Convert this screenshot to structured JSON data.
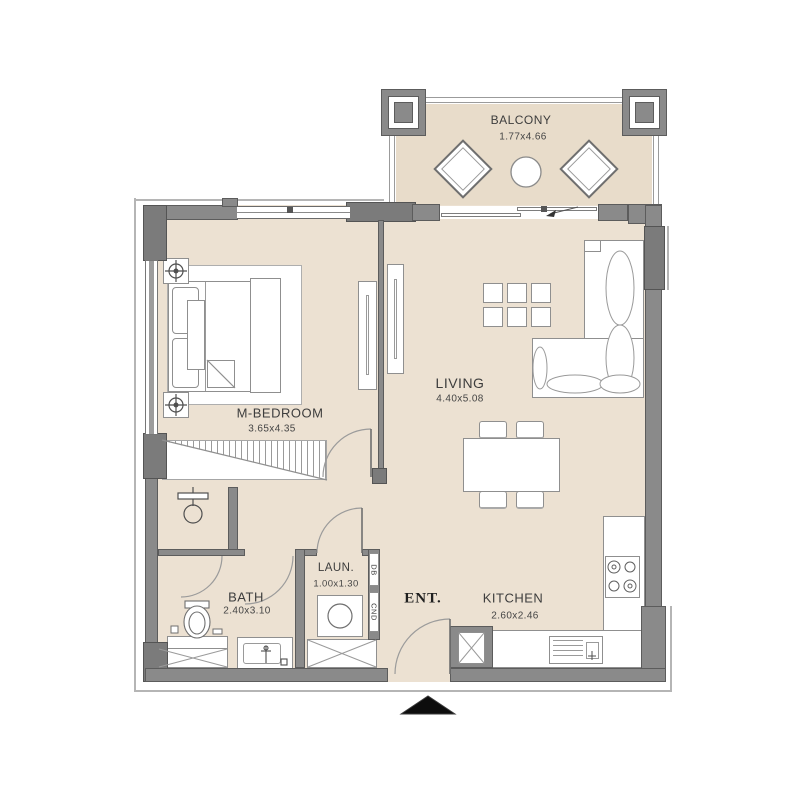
{
  "plan_type": "apartment-floor-plan",
  "rooms": {
    "balcony": {
      "label": "BALCONY",
      "dims": "1.77x4.66"
    },
    "living": {
      "label": "LIVING",
      "dims": "4.40x5.08"
    },
    "bedroom": {
      "label": "M-BEDROOM",
      "dims": "3.65x4.35"
    },
    "bath": {
      "label": "BATH",
      "dims": "2.40x3.10"
    },
    "laundry": {
      "label": "LAUN.",
      "dims": "1.00x1.30"
    },
    "entry": {
      "label": "ENT."
    },
    "kitchen": {
      "label": "KITCHEN",
      "dims": "2.60x2.46"
    }
  },
  "panels": {
    "db": "DB",
    "cnd": "CND"
  },
  "colors": {
    "floor": "#ece1d2",
    "balcony_floor": "#e8dcca",
    "wall": "#8a8a8a",
    "wall_outline": "#5c5c5c",
    "furniture_line": "#8f8f8f",
    "text": "#3d3d3d",
    "entrance_marker": "#0d0d0d"
  }
}
